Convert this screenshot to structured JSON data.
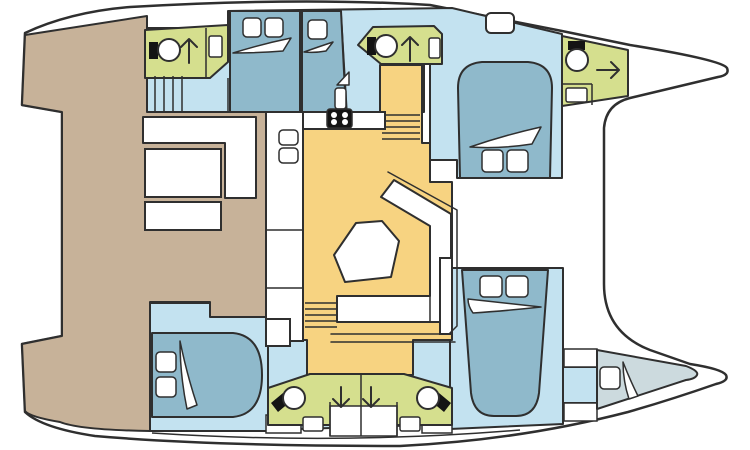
{
  "palette": {
    "background": "#ffffff",
    "deck_tan": "#c7b299",
    "hull_floor_blue": "#c3e2f0",
    "furniture_blue": "#8fb9cb",
    "bathroom_green": "#d5df8e",
    "salon_yellow": "#f7d381",
    "forepeak_gray": "#ccdade",
    "white": "#ffffff",
    "fixture_black": "#141414",
    "line": "#2f2f2f"
  },
  "diagram": {
    "type": "floor-plan",
    "subject": "catamaran-interior-layout",
    "icons": [
      "toilet-icon",
      "shower-direction-arrow-icon",
      "sink-icon",
      "stove-icon",
      "bed-icon",
      "pillow-icon",
      "blanket-icon",
      "stairs-icon",
      "bench-seat-icon",
      "dinette-table-icon",
      "deck-hatch-icon"
    ]
  }
}
